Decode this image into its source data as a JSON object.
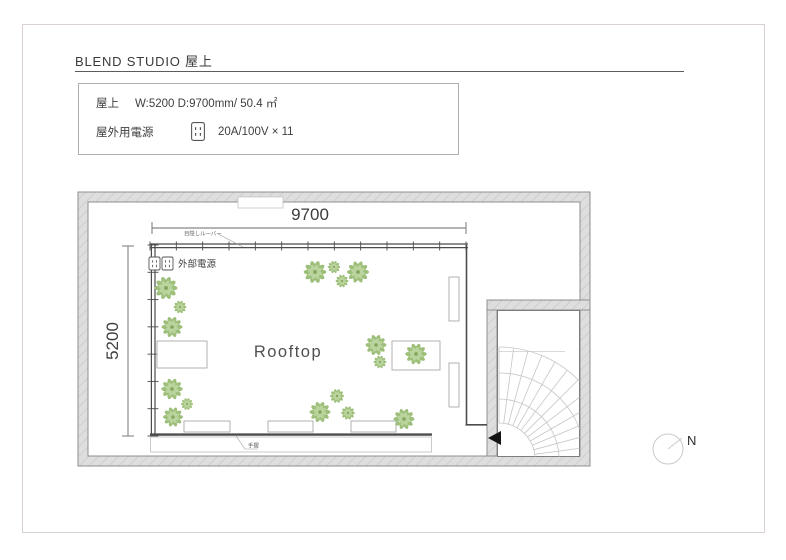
{
  "header": {
    "title": "BLEND STUDIO  屋上"
  },
  "info_box": {
    "room_label": "屋上",
    "room_value": "W:5200 D:9700mm/ 50.4 ㎡",
    "power_label": "屋外用電源",
    "power_value": "20A/100V × 11"
  },
  "plan": {
    "room_name": "Rooftop",
    "width_dim": "9700",
    "depth_dim": "5200",
    "louver_label": "目隠しルーバー",
    "external_power_label": "外部電源",
    "handrail_label": "手摺",
    "north_label": "N"
  },
  "colors": {
    "rail": "#4c4c4c",
    "wall_fill": "#dedede",
    "wall_hatch": "#c9c9c9",
    "plant_dark": "#9dbf7a",
    "plant_light": "#bad49d",
    "plant_core": "#86a660",
    "dim_text": "#3c3c3c"
  }
}
